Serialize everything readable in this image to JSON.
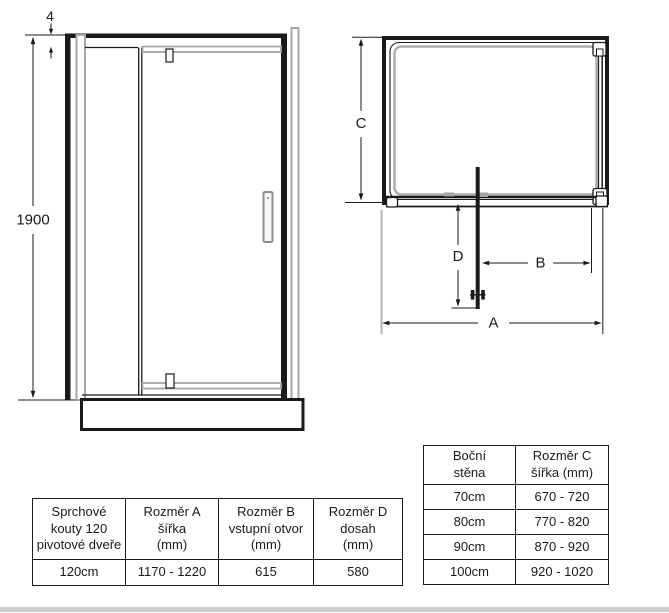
{
  "drawing": {
    "front_view": {
      "dim_gap_label": "4",
      "dim_height_label": "1900"
    },
    "top_view": {
      "dim_width_label": "A",
      "dim_opening_label": "B",
      "dim_side_label": "C",
      "dim_reach_label": "D"
    }
  },
  "door_table": {
    "headers": [
      "Sprchové\nkouty 120\npivotové dveře",
      "Rozměr A\nšířka\n(mm)",
      "Rozměr B\nvstupní otvor\n(mm)",
      "Rozměr D\ndosah\n(mm)"
    ],
    "row": [
      "120cm",
      "1170 - 1220",
      "615",
      "580"
    ]
  },
  "side_wall_table": {
    "headers": [
      "Boční\nstěna",
      "Rozměr C\nšířka (mm)"
    ],
    "rows": [
      [
        "70cm",
        "670 - 720"
      ],
      [
        "80cm",
        "770 - 820"
      ],
      [
        "90cm",
        "870 - 920"
      ],
      [
        "100cm",
        "920 - 1020"
      ]
    ]
  },
  "colors": {
    "line": "#1a1a1a",
    "profile_gray": "#a6a6a6",
    "divider_bar": "#cdcdcd"
  }
}
